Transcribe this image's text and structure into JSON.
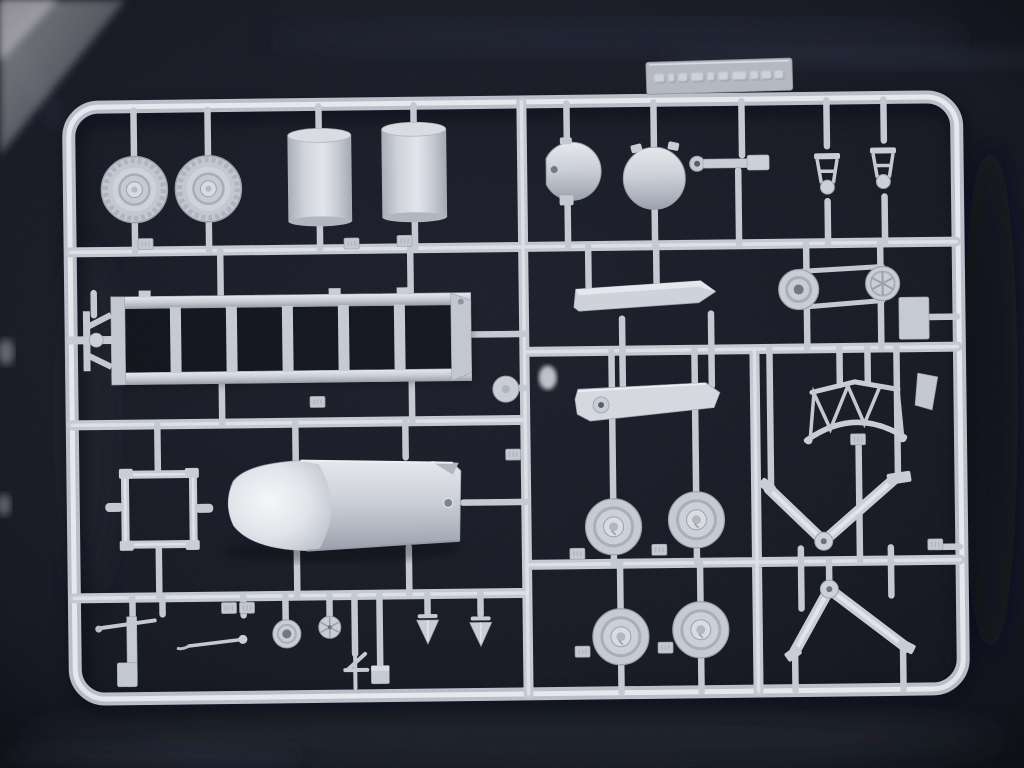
{
  "scene": {
    "type": "photograph",
    "subject": "Injection-molded plastic model kit sprue (runner frame with parts) lying on dark navy fabric",
    "sprue_material": "light gray polystyrene",
    "frame_shape": "large rounded rectangle, slightly tilted, filling most of the photo"
  },
  "colors": {
    "fabric_dark": "#0d1019",
    "fabric_mid": "#1b1e2a",
    "fabric_light": "#262a38",
    "corner_light": "#97989f",
    "plastic_base": "#c9cdd5",
    "plastic_light": "#e7e9ee",
    "plastic_mid": "#b9bec8",
    "plastic_shadow": "#9aa0ac",
    "hole_dark": "#70757f"
  },
  "marking_plate": {
    "location": "on top edge of sprue frame, right of center",
    "appearance": "raised rectangular plate with mirrored embossed manufacturer lettering",
    "text_legible": false
  },
  "part_tags": {
    "style": "small raised rectangular tabs with embossed part letters on runners",
    "letters_legible": false,
    "count_visible": 13
  },
  "parts_inventory": [
    {
      "name": "ribbed road wheel, large",
      "qty": 2,
      "area": "top left"
    },
    {
      "name": "cylindrical drum / fuel tank",
      "qty": 2,
      "area": "top left-center"
    },
    {
      "name": "disc with flattened side and hole",
      "qty": 1,
      "area": "top center"
    },
    {
      "name": "large round disc with lugs",
      "qty": 1,
      "area": "top center"
    },
    {
      "name": "tow-bar / linkage arm with eye",
      "qty": 1,
      "area": "top right-center"
    },
    {
      "name": "bell-shaped bracket",
      "qty": 2,
      "area": "top right"
    },
    {
      "name": "ladder-type chassis frame with hitch",
      "qty": 1,
      "area": "middle left"
    },
    {
      "name": "tapered ramp half",
      "qty": 2,
      "area": "middle center"
    },
    {
      "name": "belt-and-pulley assembly",
      "qty": 1,
      "area": "middle right"
    },
    {
      "name": "lattice truss arch",
      "qty": 1,
      "area": "middle right"
    },
    {
      "name": "square sub-frame",
      "qty": 1,
      "area": "lower left"
    },
    {
      "name": "hull half with rounded nose cone",
      "qty": 1,
      "area": "lower left-center"
    },
    {
      "name": "small road wheel",
      "qty": 4,
      "area": "lower center, 2x2 grid"
    },
    {
      "name": "V-shaped support arm with pivot boss",
      "qty": 2,
      "area": "lower right"
    },
    {
      "name": "small pivot disc",
      "qty": 1,
      "area": "center runner"
    },
    {
      "name": "assorted small fittings: levers, ring disc, spoked wheel, stand, block, cones",
      "qty": 10,
      "area": "bottom strip"
    }
  ]
}
